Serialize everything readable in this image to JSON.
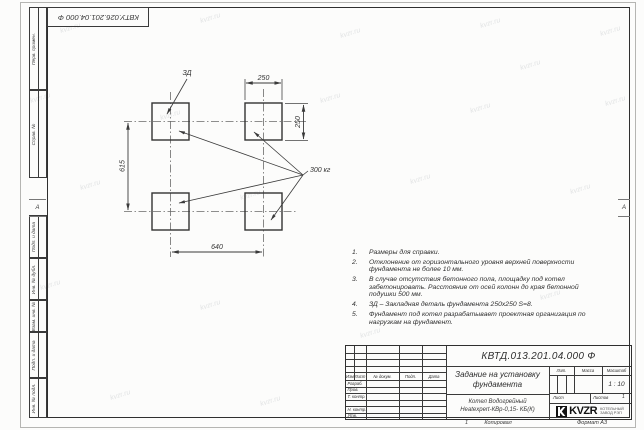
{
  "sheet": {
    "top_stamp_designation": "КВТУ.026.201.04.000 Ф",
    "zone_marker": "А"
  },
  "margin_labels": [
    "Перв. примен.",
    "Справ. №",
    "Подп. и дата",
    "Инв. № дубл.",
    "Взам. инв. №",
    "Подп. и дата",
    "Инв. № подл."
  ],
  "drawing": {
    "embed_label": "ЗД",
    "load_label": "300 кг",
    "dims": {
      "top": "250",
      "right": "250",
      "left": "615",
      "bottom": "640"
    }
  },
  "notes": [
    {
      "num": "1.",
      "text": "Размеры для справки."
    },
    {
      "num": "2.",
      "text": "Отклонение от горизонтального уровня верхней поверхности\nфундамента не более 10 мм."
    },
    {
      "num": "3.",
      "text": "В случае отсутствия бетонного пола, площадку под котел\nзабетонировать. Расстояние от осей колонн до края бетонной\nподушки 500 мм."
    },
    {
      "num": "4.",
      "text": "ЗД – Закладная деталь фундамента 250х250 S=8."
    },
    {
      "num": "5.",
      "text": "Фундамент под котел разрабатывает проектная организация по\nнагрузкам на фундамент."
    }
  ],
  "title_block": {
    "designation": "КВТД.013.201.04.000 Ф",
    "doc_title": "Задание на установку\nфундамента",
    "product_line1": "Котел Водогрейный",
    "product_line2": "Heatexpert-КВр-0,15- КБ(К)",
    "header_cols": [
      "Изм",
      "Лист",
      "№ докум.",
      "Подп.",
      "Дата"
    ],
    "sig_rows": [
      "Разраб.",
      "Пров.",
      "Т. контр.",
      "",
      "Н. контр.",
      "Утв."
    ],
    "lit_label": "Лит.",
    "mass_label": "Масса",
    "scale_label": "Масштаб",
    "scale_value": "1 : 10",
    "sheet_label": "Лист",
    "sheets_label": "Листов",
    "sheets_value": "1",
    "logo_text": "KVZR",
    "logo_caption1": "КОТЕЛЬНЫЙ",
    "logo_caption2": "ЗАВОД РЭП",
    "bottom_num": "1",
    "copied_label": "Копировал",
    "format_label": "Формат А3"
  },
  "watermark": {
    "text": "kvzr.ru"
  },
  "colors": {
    "line": "#3a3a3a",
    "centerline": "#6a6a6a",
    "logo_bg": "#111111"
  }
}
